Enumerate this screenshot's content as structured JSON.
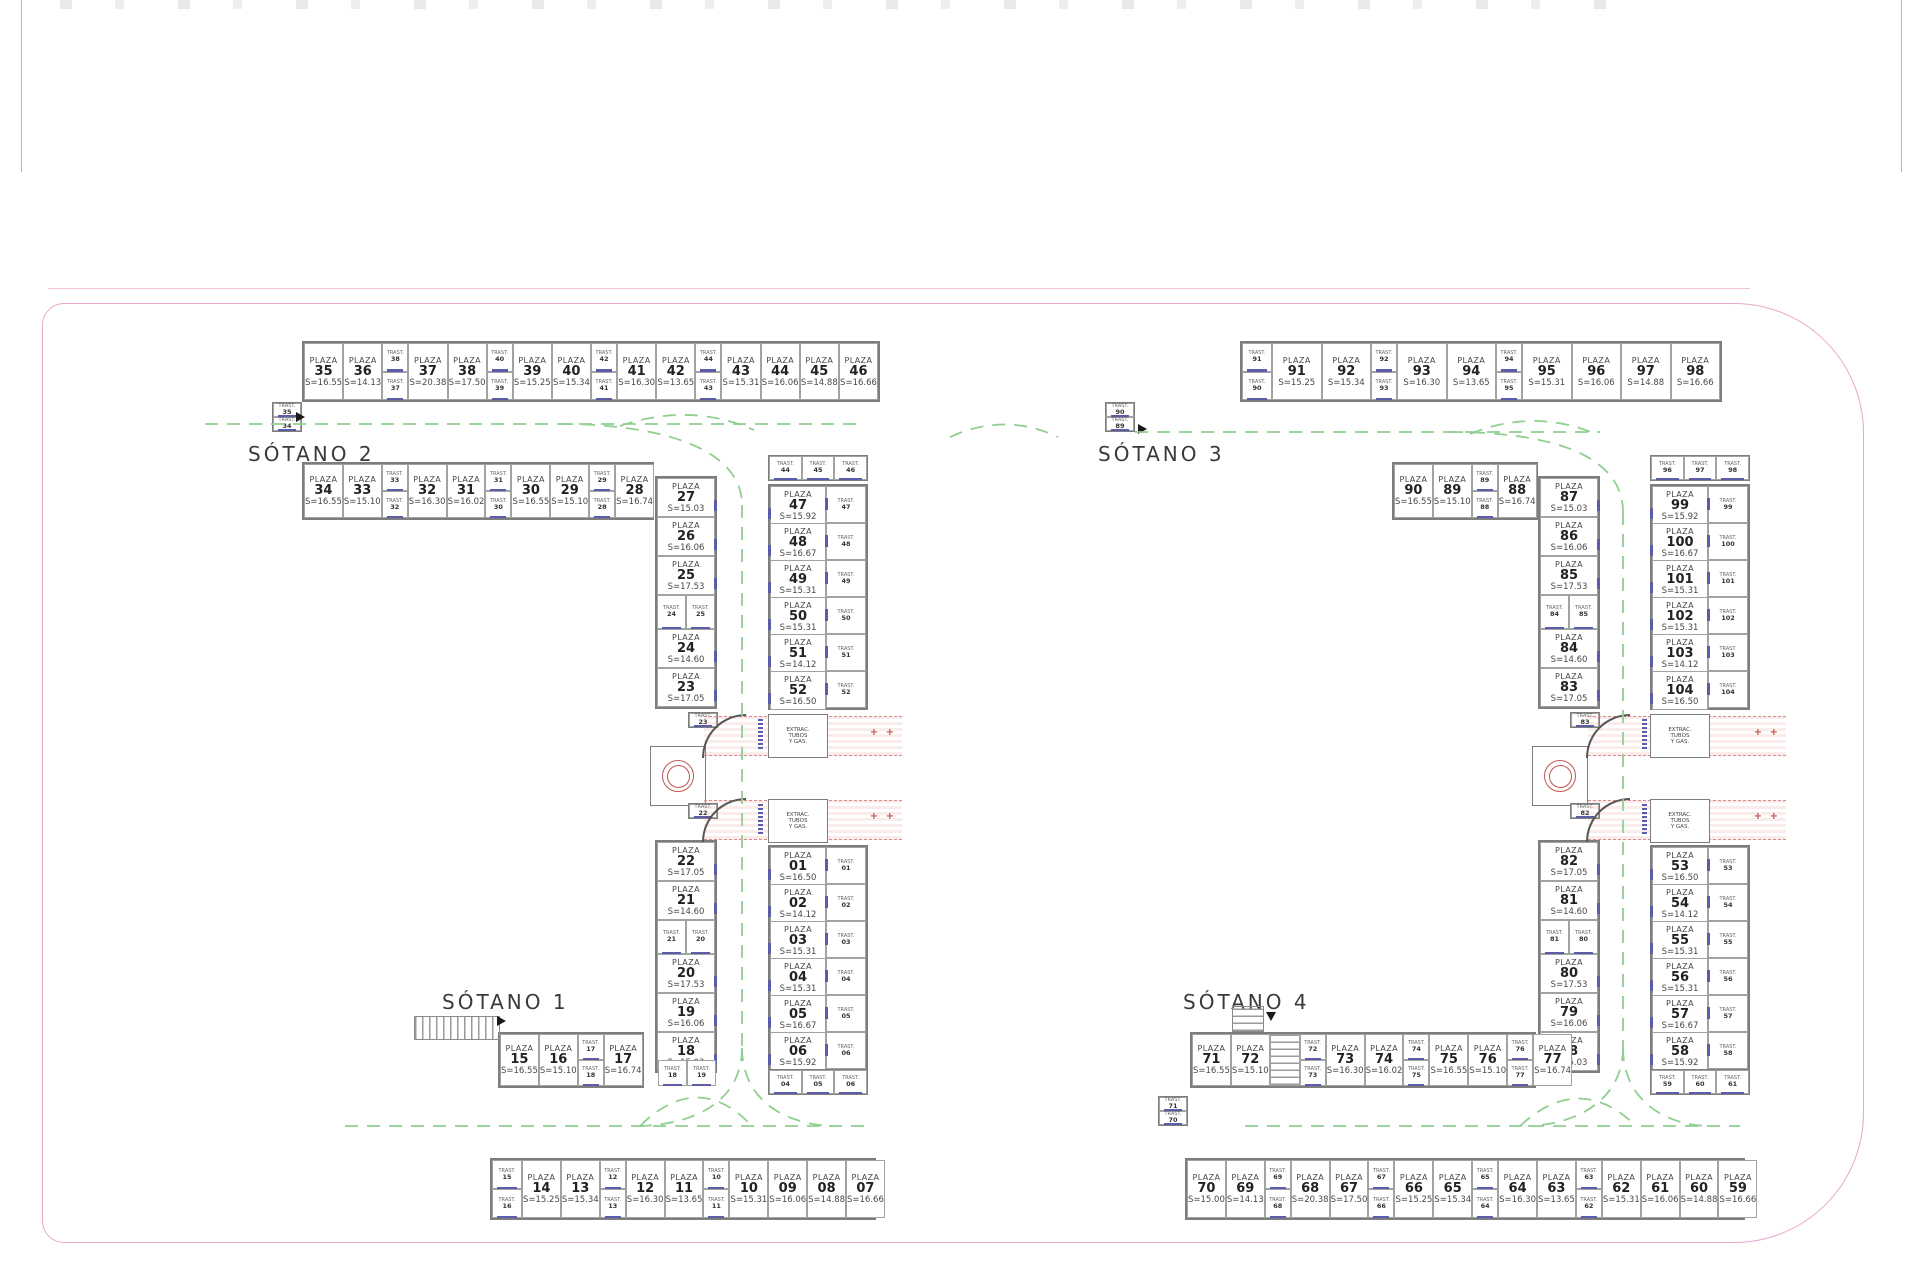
{
  "labels": {
    "sotano1": "SÓTANO 1",
    "sotano2": "SÓTANO 2",
    "sotano3": "SÓTANO 3",
    "sotano4": "SÓTANO 4"
  },
  "words": {
    "plaza": "PLAZA",
    "trast": "TRAST.",
    "extract_lines": [
      "EXTRAC.",
      "TUBOS",
      "Y GAS."
    ]
  },
  "colors": {
    "boundary_pink": "#e6a8cd",
    "lane_green": "#90cf90",
    "ramp_red": "#bf5450",
    "door_blue": "#5a5da8",
    "wall_gray": "#7d7d7d"
  },
  "sections": {
    "l-top-row": {
      "kind": "row",
      "items": [
        {
          "n": "35",
          "s": "S=16.55"
        },
        {
          "n": "36",
          "s": "S=14.13"
        },
        {
          "tv": [
            "38",
            "37"
          ]
        },
        {
          "n": "37",
          "s": "S=20.38"
        },
        {
          "n": "38",
          "s": "S=17.50"
        },
        {
          "tv": [
            "40",
            "39"
          ]
        },
        {
          "n": "39",
          "s": "S=15.25"
        },
        {
          "n": "40",
          "s": "S=15.34"
        },
        {
          "tv": [
            "42",
            "41"
          ]
        },
        {
          "n": "41",
          "s": "S=16.30"
        },
        {
          "n": "42",
          "s": "S=13.65"
        },
        {
          "tv": [
            "44",
            "43"
          ]
        },
        {
          "n": "43",
          "s": "S=15.31"
        },
        {
          "n": "44",
          "s": "S=16.06"
        },
        {
          "n": "45",
          "s": "S=14.88"
        },
        {
          "n": "46",
          "s": "S=16.66"
        }
      ]
    },
    "l-second-row": {
      "kind": "row",
      "items": [
        {
          "n": "34",
          "s": "S=16.55"
        },
        {
          "n": "33",
          "s": "S=15.10"
        },
        {
          "tv": [
            "33",
            "32"
          ]
        },
        {
          "n": "32",
          "s": "S=16.30"
        },
        {
          "n": "31",
          "s": "S=16.02"
        },
        {
          "tv": [
            "31",
            "30"
          ]
        },
        {
          "n": "30",
          "s": "S=16.55"
        },
        {
          "n": "29",
          "s": "S=15.10"
        },
        {
          "tv": [
            "29",
            "28"
          ]
        },
        {
          "n": "28",
          "s": "S=16.74"
        }
      ]
    },
    "l-stack-a": {
      "kind": "stack",
      "items": [
        "35",
        "34"
      ]
    },
    "l-west-col-upper": {
      "kind": "col",
      "items": [
        {
          "n": "27",
          "s": "S=15.03"
        },
        {
          "n": "26",
          "s": "S=16.06"
        },
        {
          "n": "25",
          "s": "S=17.53"
        },
        {
          "th": [
            "24",
            "25"
          ]
        },
        {
          "n": "24",
          "s": "S=14.60"
        },
        {
          "n": "23",
          "s": "S=17.05"
        }
      ]
    },
    "l-mini-23": {
      "kind": "stack",
      "items": [
        "23"
      ]
    },
    "l-mini-22": {
      "kind": "stack",
      "items": [
        "22"
      ]
    },
    "l-west-col-lower": {
      "kind": "col",
      "items": [
        {
          "n": "22",
          "s": "S=17.05"
        },
        {
          "n": "21",
          "s": "S=14.60"
        },
        {
          "th": [
            "21",
            "20"
          ]
        },
        {
          "n": "20",
          "s": "S=17.53"
        },
        {
          "n": "19",
          "s": "S=16.06"
        },
        {
          "n": "18",
          "s": "S=15.03"
        }
      ]
    },
    "l-trio-top": {
      "kind": "trio",
      "items": [
        "44",
        "45",
        "46"
      ]
    },
    "l-east-col-upper": {
      "kind": "colT",
      "items": [
        {
          "n": "47",
          "s": "S=15.92",
          "t": "47"
        },
        {
          "n": "48",
          "s": "S=16.67",
          "t": "48"
        },
        {
          "n": "49",
          "s": "S=15.31",
          "t": "49"
        },
        {
          "n": "50",
          "s": "S=15.31",
          "t": "50"
        },
        {
          "n": "51",
          "s": "S=14.12",
          "t": "51"
        },
        {
          "n": "52",
          "s": "S=16.50",
          "t": "52"
        }
      ]
    },
    "l-east-col-lower": {
      "kind": "colT",
      "items": [
        {
          "n": "01",
          "s": "S=16.50",
          "t": "01"
        },
        {
          "n": "02",
          "s": "S=14.12",
          "t": "02"
        },
        {
          "n": "03",
          "s": "S=15.31",
          "t": "03"
        },
        {
          "n": "04",
          "s": "S=15.31",
          "t": "04"
        },
        {
          "n": "05",
          "s": "S=16.67",
          "t": "05"
        },
        {
          "n": "06",
          "s": "S=15.92",
          "t": "06"
        }
      ]
    },
    "l-trio-bottom": {
      "kind": "trio",
      "items": [
        "04",
        "05",
        "06"
      ]
    },
    "l-bottom-upper-row": {
      "kind": "row",
      "items": [
        {
          "n": "15",
          "s": "S=16.55"
        },
        {
          "n": "16",
          "s": "S=15.10"
        },
        {
          "tv": [
            "17",
            "18"
          ]
        },
        {
          "n": "17",
          "s": "S=16.74"
        }
      ]
    },
    "l-minipair-18": {
      "kind": "trio",
      "items": [
        "18",
        "19"
      ]
    },
    "l-bottom-row": {
      "kind": "row",
      "items": [
        {
          "stk": [
            "15",
            "16"
          ]
        },
        {
          "n": "14",
          "s": "S=15.25"
        },
        {
          "n": "13",
          "s": "S=15.34"
        },
        {
          "tv": [
            "12",
            "13"
          ]
        },
        {
          "n": "12",
          "s": "S=16.30"
        },
        {
          "n": "11",
          "s": "S=13.65"
        },
        {
          "tv": [
            "10",
            "11"
          ]
        },
        {
          "n": "10",
          "s": "S=15.31"
        },
        {
          "n": "09",
          "s": "S=16.06"
        },
        {
          "n": "08",
          "s": "S=14.88"
        },
        {
          "n": "07",
          "s": "S=16.66"
        }
      ]
    },
    "r-top-row": {
      "kind": "row",
      "items": [
        {
          "stk": [
            "91",
            "90"
          ]
        },
        {
          "n": "91",
          "s": "S=15.25"
        },
        {
          "n": "92",
          "s": "S=15.34"
        },
        {
          "tv": [
            "92",
            "93"
          ]
        },
        {
          "n": "93",
          "s": "S=16.30"
        },
        {
          "n": "94",
          "s": "S=13.65"
        },
        {
          "tv": [
            "94",
            "95"
          ]
        },
        {
          "n": "95",
          "s": "S=15.31"
        },
        {
          "n": "96",
          "s": "S=16.06"
        },
        {
          "n": "97",
          "s": "S=14.88"
        },
        {
          "n": "98",
          "s": "S=16.66"
        }
      ]
    },
    "r-second-row": {
      "kind": "row",
      "items": [
        {
          "n": "90",
          "s": "S=16.55"
        },
        {
          "n": "89",
          "s": "S=15.10"
        },
        {
          "tv": [
            "89",
            "88"
          ]
        },
        {
          "n": "88",
          "s": "S=16.74"
        }
      ]
    },
    "r-stack-a": {
      "kind": "stack",
      "items": [
        "90",
        "89"
      ]
    },
    "r-west-col-upper": {
      "kind": "col",
      "items": [
        {
          "n": "87",
          "s": "S=15.03"
        },
        {
          "n": "86",
          "s": "S=16.06"
        },
        {
          "n": "85",
          "s": "S=17.53"
        },
        {
          "th": [
            "84",
            "85"
          ]
        },
        {
          "n": "84",
          "s": "S=14.60"
        },
        {
          "n": "83",
          "s": "S=17.05"
        }
      ]
    },
    "r-mini-83": {
      "kind": "stack",
      "items": [
        "83"
      ]
    },
    "r-mini-82": {
      "kind": "stack",
      "items": [
        "82"
      ]
    },
    "r-west-col-lower": {
      "kind": "col",
      "items": [
        {
          "n": "82",
          "s": "S=17.05"
        },
        {
          "n": "81",
          "s": "S=14.60"
        },
        {
          "th": [
            "81",
            "80"
          ]
        },
        {
          "n": "80",
          "s": "S=17.53"
        },
        {
          "n": "79",
          "s": "S=16.06"
        },
        {
          "n": "78",
          "s": "S=15.03"
        }
      ]
    },
    "r-trio-top": {
      "kind": "trio",
      "items": [
        "96",
        "97",
        "98"
      ]
    },
    "r-east-col-upper": {
      "kind": "colT",
      "items": [
        {
          "n": "99",
          "s": "S=15.92",
          "t": "99"
        },
        {
          "n": "100",
          "s": "S=16.67",
          "t": "100"
        },
        {
          "n": "101",
          "s": "S=15.31",
          "t": "101"
        },
        {
          "n": "102",
          "s": "S=15.31",
          "t": "102"
        },
        {
          "n": "103",
          "s": "S=14.12",
          "t": "103"
        },
        {
          "n": "104",
          "s": "S=16.50",
          "t": "104"
        }
      ]
    },
    "r-east-col-lower": {
      "kind": "colT",
      "items": [
        {
          "n": "53",
          "s": "S=16.50",
          "t": "53"
        },
        {
          "n": "54",
          "s": "S=14.12",
          "t": "54"
        },
        {
          "n": "55",
          "s": "S=15.31",
          "t": "55"
        },
        {
          "n": "56",
          "s": "S=15.31",
          "t": "56"
        },
        {
          "n": "57",
          "s": "S=16.67",
          "t": "57"
        },
        {
          "n": "58",
          "s": "S=15.92",
          "t": "58"
        }
      ]
    },
    "r-trio-bottom": {
      "kind": "trio",
      "items": [
        "59",
        "60",
        "61"
      ]
    },
    "r-bottom-upper-row": {
      "kind": "row",
      "items": [
        {
          "n": "71",
          "s": "S=16.55"
        },
        {
          "n": "72",
          "s": "S=15.10"
        },
        {
          "st": true
        },
        {
          "tv": [
            "72",
            "73"
          ]
        },
        {
          "n": "73",
          "s": "S=16.30"
        },
        {
          "n": "74",
          "s": "S=16.02"
        },
        {
          "tv": [
            "74",
            "75"
          ]
        },
        {
          "n": "75",
          "s": "S=16.55"
        },
        {
          "n": "76",
          "s": "S=15.10"
        },
        {
          "tv": [
            "76",
            "77"
          ]
        },
        {
          "n": "77",
          "s": "S=16.74"
        }
      ]
    },
    "r-stack-b": {
      "kind": "stack",
      "items": [
        "71",
        "70"
      ]
    },
    "r-bottom-row": {
      "kind": "row",
      "items": [
        {
          "n": "70",
          "s": "S=15.00"
        },
        {
          "n": "69",
          "s": "S=14.13"
        },
        {
          "tv": [
            "69",
            "68"
          ]
        },
        {
          "n": "68",
          "s": "S=20.38"
        },
        {
          "n": "67",
          "s": "S=17.50"
        },
        {
          "tv": [
            "67",
            "66"
          ]
        },
        {
          "n": "66",
          "s": "S=15.25"
        },
        {
          "n": "65",
          "s": "S=15.34"
        },
        {
          "tv": [
            "65",
            "64"
          ]
        },
        {
          "n": "64",
          "s": "S=16.30"
        },
        {
          "n": "63",
          "s": "S=13.65"
        },
        {
          "tv": [
            "63",
            "62"
          ]
        },
        {
          "n": "62",
          "s": "S=15.31"
        },
        {
          "n": "61",
          "s": "S=16.06"
        },
        {
          "n": "60",
          "s": "S=14.88"
        },
        {
          "n": "59",
          "s": "S=16.66"
        }
      ]
    }
  }
}
